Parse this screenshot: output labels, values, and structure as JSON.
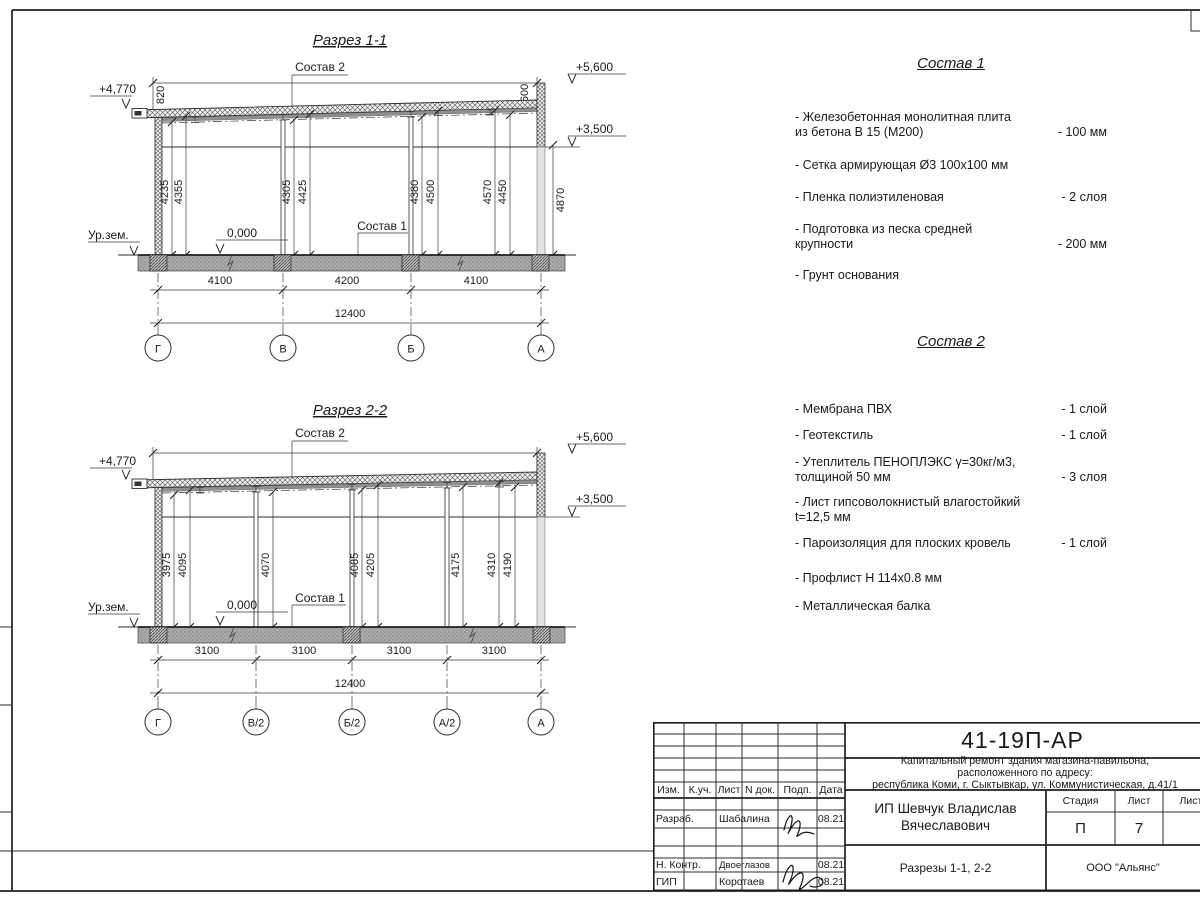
{
  "section1": {
    "title": "Разрез 1-1",
    "sostav2_label": "Состав 2",
    "sostav1_label": "Состав 1",
    "ground_label": "Ур.зем.",
    "zero_mark": "0,000",
    "elev_left": "+4,770",
    "elev_top_right": "+5,600",
    "elev_mid_right": "+3,500",
    "dim_roof_left": "820",
    "dim_roof_right": "600",
    "dim_right_total": "4870",
    "heights": [
      "4235",
      "4355",
      "4305",
      "4425",
      "4380",
      "4500",
      "4570",
      "4450"
    ],
    "bottom_dims": [
      "4100",
      "4200",
      "4100"
    ],
    "total_dim": "12400",
    "axes": [
      "Г",
      "В",
      "Б",
      "А"
    ]
  },
  "section2": {
    "title": "Разрез 2-2",
    "sostav2_label": "Состав 2",
    "sostav1_label": "Состав 1",
    "ground_label": "Ур.зем.",
    "zero_mark": "0,000",
    "elev_left": "+4,770",
    "elev_top_right": "+5,600",
    "elev_mid_right": "+3,500",
    "heights": [
      "3975",
      "4095",
      "4070",
      "4085",
      "4205",
      "4175",
      "4310",
      "4190"
    ],
    "bottom_dims": [
      "3100",
      "3100",
      "3100",
      "3100"
    ],
    "total_dim": "12400",
    "axes": [
      "Г",
      "В/2",
      "Б/2",
      "А/2",
      "А"
    ]
  },
  "sostav1": {
    "title": "Состав 1",
    "items": [
      {
        "name": "- Железобетонная  монолитная плита\nиз бетона В 15 (М200)",
        "value": "- 100 мм"
      },
      {
        "name": "- Сетка армирующая Ø3 100х100 мм",
        "value": ""
      },
      {
        "name": "- Пленка полиэтиленовая",
        "value": "- 2 слоя"
      },
      {
        "name": "- Подготовка из песка средней\nкрупности",
        "value": "- 200 мм"
      },
      {
        "name": "- Грунт основания",
        "value": ""
      }
    ]
  },
  "sostav2": {
    "title": "Состав 2",
    "items": [
      {
        "name": "- Мембрана ПВХ",
        "value": "- 1 слой"
      },
      {
        "name": "- Геотекстиль",
        "value": "- 1 слой"
      },
      {
        "name": "- Утеплитель ПЕНОПЛЭКС γ=30кг/м3,\nтолщиной 50 мм",
        "value": "- 3 слоя"
      },
      {
        "name": "- Лист гипсоволокнистый влагостойкий\nt=12,5 мм",
        "value": ""
      },
      {
        "name": "- Пароизоляция для плоских кровель",
        "value": "- 1 слой"
      },
      {
        "name": "- Профлист Н 114х0.8 мм",
        "value": ""
      },
      {
        "name": "- Металлическая балка",
        "value": ""
      }
    ]
  },
  "titleblock": {
    "doc_number": "41-19П-АР",
    "project_line1": "Капитальный ремонт здания магазина-павильона,",
    "project_line2": "расположенного по адресу:",
    "project_line3": "республика Коми, г. Сыктывкар, ул. Коммунистическая, д.41/1",
    "client": "ИП Шевчук Владислав Вячеславович",
    "sheet_title": "Разрезы 1-1, 2-2",
    "company": "ООО \"Альянс\"",
    "stage_label": "Стадия",
    "sheet_label": "Лист",
    "sheets_label": "Листов",
    "stage": "П",
    "sheet": "7",
    "columns": [
      "Изм.",
      "К.уч.",
      "Лист",
      "N док.",
      "Подп.",
      "Дата"
    ],
    "rows": [
      {
        "role": "Разраб.",
        "name": "Шабалина",
        "date": "08.21"
      },
      {
        "role": "Н. Контр.",
        "name": "Двоеглазов",
        "date": "08.21"
      },
      {
        "role": "ГИП",
        "name": "Коротаев",
        "date": "08.21"
      }
    ]
  }
}
